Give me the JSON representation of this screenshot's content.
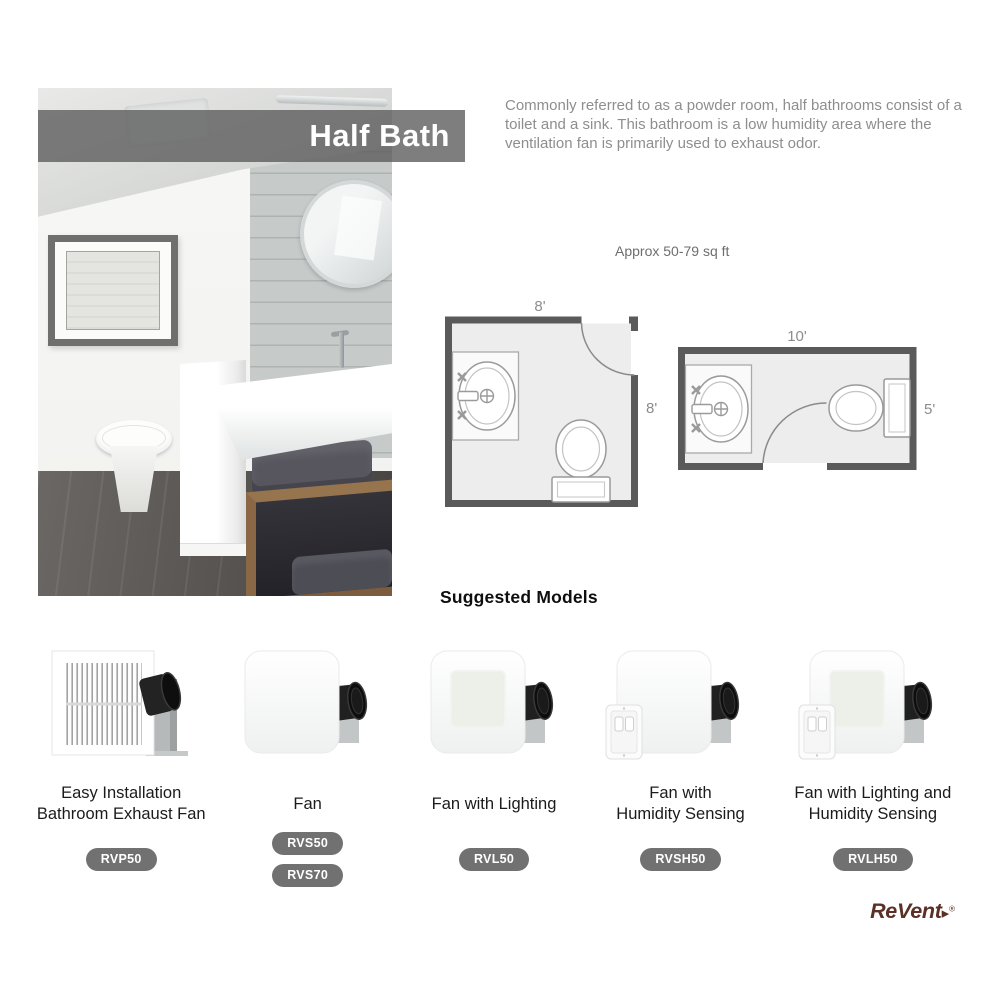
{
  "banner": {
    "title": "Half Bath"
  },
  "intro": "Commonly referred to as a powder room, half bathrooms consist of a toilet and a sink. This bathroom is a low humidity area where the ventilation fan is primarily used to exhaust odor.",
  "size_note": "Approx 50-79 sq ft",
  "floorplans": [
    {
      "name": "square-half-bath",
      "width_label": "8'",
      "depth_label": "8'"
    },
    {
      "name": "narrow-half-bath",
      "width_label": "10'",
      "depth_label": "5'"
    }
  ],
  "suggested_models": {
    "title": "Suggested Models",
    "products": [
      {
        "name": "Easy Installation\nBathroom Exhaust Fan",
        "image": "grille-fan",
        "models": [
          "RVP50"
        ]
      },
      {
        "name": "Fan",
        "image": "cover-fan",
        "models": [
          "RVS50",
          "RVS70"
        ]
      },
      {
        "name": "Fan with Lighting",
        "image": "cover-fan-light",
        "models": [
          "RVL50"
        ]
      },
      {
        "name": "Fan with\nHumidity Sensing",
        "image": "cover-fan-humidity",
        "models": [
          "RVSH50"
        ]
      },
      {
        "name": "Fan with Lighting and\nHumidity Sensing",
        "image": "cover-fan-light-humidity",
        "models": [
          "RVLH50"
        ]
      }
    ]
  },
  "brand": {
    "name": "ReVent",
    "arrow": "▸",
    "registered": "®"
  },
  "colors": {
    "banner_gray": "#7e7e7e",
    "badge_gray": "#717171",
    "plan_wall_gray": "#5a5a5a",
    "plan_room_fill": "#ededed",
    "brand_brown": "#5b3026",
    "body_text_gray": "#8e8e8e"
  }
}
